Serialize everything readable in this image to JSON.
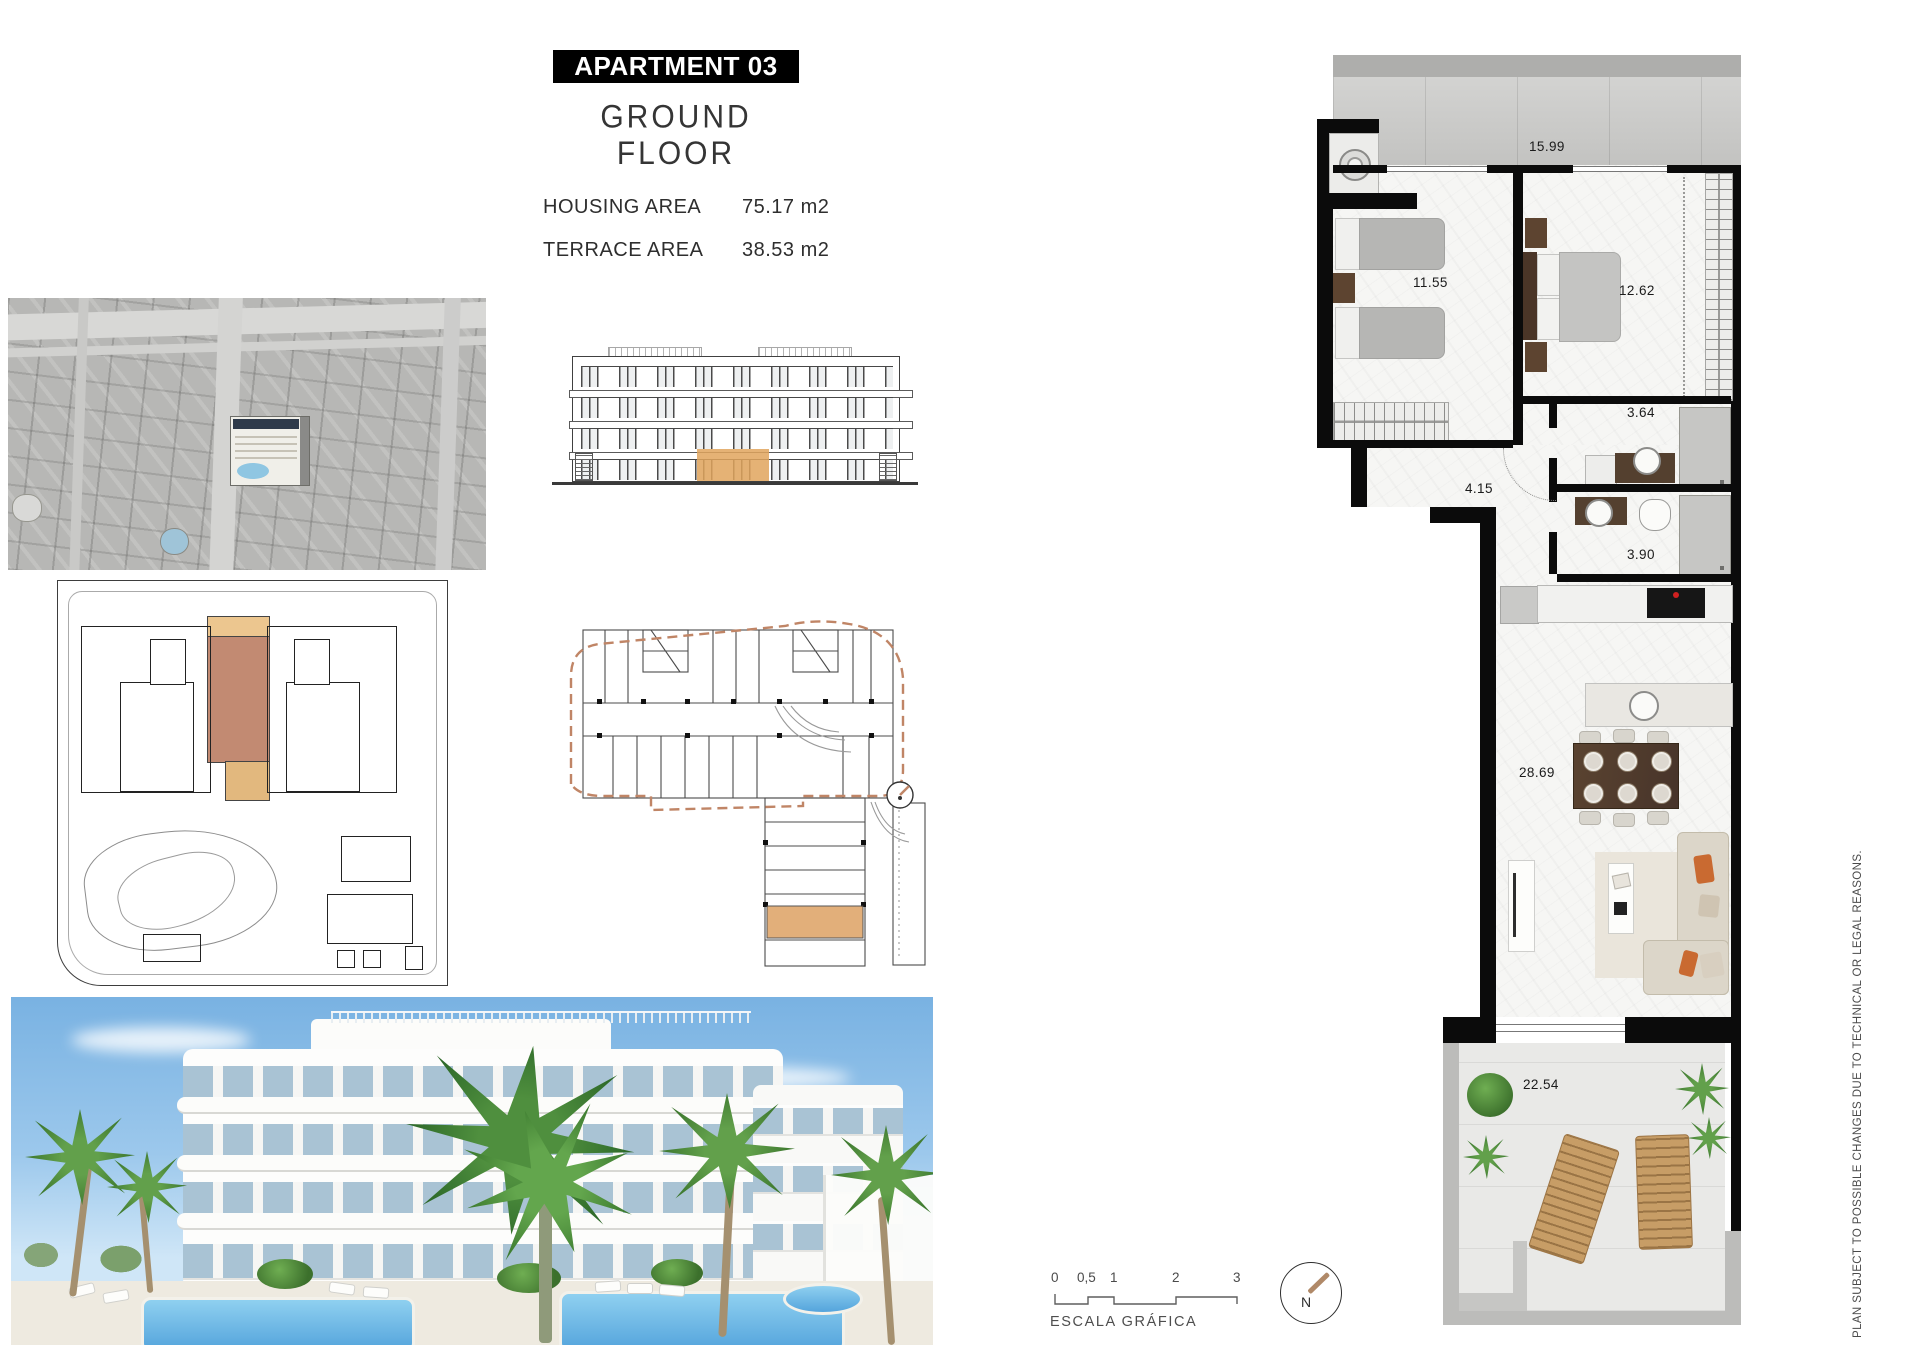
{
  "header": {
    "apartment_label": "APARTMENT 03",
    "floor_label": "GROUND FLOOR",
    "housing_area_label": "HOUSING AREA",
    "housing_area_value": "75.17 m2",
    "terrace_area_label": "TERRACE AREA",
    "terrace_area_value": "38.53 m2"
  },
  "floor_plan": {
    "areas": {
      "top_terrace": "15.99",
      "bedroom_twin": "11.55",
      "bedroom_master": "12.62",
      "bathroom_1": "3.64",
      "hallway": "4.15",
      "bathroom_2": "3.90",
      "living_dining": "28.69",
      "main_terrace": "22.54"
    }
  },
  "scale_bar": {
    "ticks": [
      "0",
      "0,5",
      "1",
      "2",
      "3"
    ],
    "caption": "ESCALA GRÁFICA"
  },
  "compass": {
    "north_label": "N"
  },
  "disclaimer": {
    "text": "PLAN SUBJECT TO POSSIBLE CHANGES DUE TO TECHNICAL OR LEGAL REASONS."
  },
  "colors": {
    "highlight_tan": "#e6bc85",
    "highlight_brown": "#c28a72",
    "wall_black": "#0b0b0b",
    "wood_dark": "#54402f",
    "cushion_orange": "#c96a31",
    "lounger_wood": "#c79d66",
    "pool_blue": "#54a4dc",
    "plant_green": "#4e8c3c",
    "concrete_gray": "#bcbcba",
    "compass_needle": "#b08968"
  }
}
